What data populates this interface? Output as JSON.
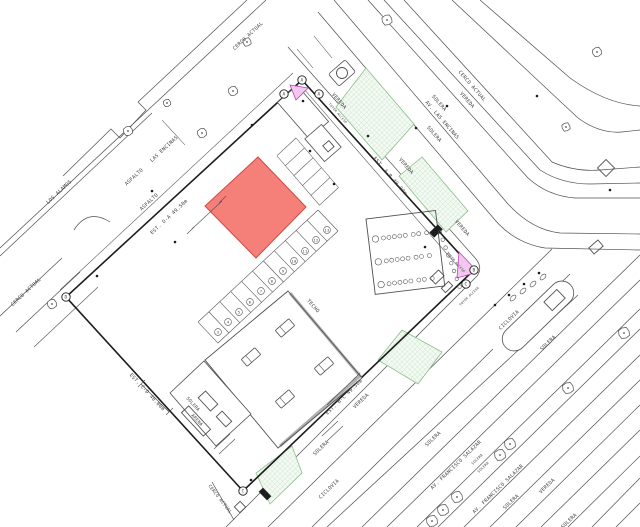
{
  "colors": {
    "line": "#4f4f4f",
    "boundary": "#1c1c1c",
    "text": "#3c3c3c",
    "dark": "#1d1d1d",
    "red_fill": "#f58079",
    "red_stroke": "#cf4a42",
    "green_bg": "#f4faf4",
    "green_line": "#b4d6b4",
    "green_stroke": "#8cbe8c",
    "pink_fill": "#f2c8f0",
    "pink_stroke": "#bf42bb"
  },
  "labels": {
    "street": [
      {
        "text": "CERCO ACTUAL",
        "x": 249,
        "y": 37,
        "rot": -43
      },
      {
        "text": "LAS ENCINAS",
        "x": 165,
        "y": 150,
        "rot": -43
      },
      {
        "text": "ASFALTO",
        "x": 135,
        "y": 178,
        "rot": -43
      },
      {
        "text": "ASFALTO",
        "x": 150,
        "y": 203,
        "rot": -43
      },
      {
        "text": "LOS ALAMOS",
        "x": 60,
        "y": 193,
        "rot": -43
      },
      {
        "text": "CERCO ACTUAL",
        "x": 27,
        "y": 293,
        "rot": -43
      },
      {
        "text": "CERCO ACTUAL",
        "x": 471,
        "y": 87,
        "rot": 49
      },
      {
        "text": "VEREDA",
        "x": 466,
        "y": 101,
        "rot": 49
      },
      {
        "text": "SOLERA",
        "x": 438,
        "y": 104,
        "rot": 49
      },
      {
        "text": "AV. LAS ENCINAS",
        "x": 441,
        "y": 121,
        "rot": 49
      },
      {
        "text": "SOLERA",
        "x": 433,
        "y": 135,
        "rot": 49
      },
      {
        "text": "VEREDA",
        "x": 338,
        "y": 102,
        "rot": 49
      },
      {
        "text": "VEREDA",
        "x": 405,
        "y": 167,
        "rot": 49
      },
      {
        "text": "VEREDA",
        "x": 461,
        "y": 229,
        "rot": 49
      },
      {
        "text": "TECHO",
        "x": 312,
        "y": 307,
        "rot": 49
      },
      {
        "text": "VEREDA",
        "x": 362,
        "y": 402,
        "rot": -44
      },
      {
        "text": "SOLERA",
        "x": 322,
        "y": 449,
        "rot": -44
      },
      {
        "text": "CICLOVIA",
        "x": 330,
        "y": 490,
        "rot": -44
      },
      {
        "text": "CICLOVIA",
        "x": 510,
        "y": 321,
        "rot": -44
      },
      {
        "text": "SOLERA",
        "x": 549,
        "y": 344,
        "rot": -44
      },
      {
        "text": "SOLERA",
        "x": 192,
        "y": 405,
        "rot": 47,
        "size": 4.5
      },
      {
        "text": "ARENA",
        "x": 196,
        "y": 421,
        "rot": 47,
        "size": 4.5
      },
      {
        "text": "CERCO ACTUAL",
        "x": 219,
        "y": 500,
        "rot": 52,
        "size": 4.5
      },
      {
        "text": "SOLERA",
        "x": 434,
        "y": 440,
        "rot": -44
      },
      {
        "text": "AV. FRANCISCO SALAZAR",
        "x": 457,
        "y": 466,
        "rot": -44
      },
      {
        "text": "SOLERA",
        "x": 478,
        "y": 460,
        "rot": -44,
        "size": 3.5
      },
      {
        "text": "SOLERA",
        "x": 484,
        "y": 468,
        "rot": -44,
        "size": 3.5
      },
      {
        "text": "AV. FRANCISCO SALAZAR",
        "x": 499,
        "y": 490,
        "rot": -44
      },
      {
        "text": "SOLERA",
        "x": 512,
        "y": 503,
        "rot": -44
      },
      {
        "text": "VEREDA",
        "x": 548,
        "y": 487,
        "rot": -44
      },
      {
        "text": "SOLERA",
        "x": 570,
        "y": 522,
        "rot": -44
      }
    ],
    "dimensions": [
      {
        "text": "EST. D-A 49.50m",
        "x": 170,
        "y": 218,
        "rot": -43
      },
      {
        "text": "EST. A-B 40.00m",
        "x": 389,
        "y": 177,
        "rot": 49
      },
      {
        "text": "EST. B-C 49.50m",
        "x": 345,
        "y": 398,
        "rot": -44
      },
      {
        "text": "EST. C-D 40.00m",
        "x": 146,
        "y": 393,
        "rot": 47
      }
    ],
    "small": [
      {
        "text": "TOTEM ACCESO",
        "x": 337,
        "y": 114,
        "rot": 49
      },
      {
        "text": "TOTEM ACCESO",
        "x": 455,
        "y": 263,
        "rot": 49
      },
      {
        "text": "TOTEM ACCESO",
        "x": 470,
        "y": 297,
        "rot": -44
      }
    ]
  },
  "markers": {
    "vertices": [
      {
        "letter": "A",
        "x": 302,
        "y": 80
      },
      {
        "letter": "B",
        "x": 474,
        "y": 270
      },
      {
        "letter": "C",
        "x": 243,
        "y": 491
      },
      {
        "letter": "D",
        "x": 66,
        "y": 297
      },
      {
        "letter": "A",
        "x": 284,
        "y": 94
      },
      {
        "letter": "A",
        "x": 319,
        "y": 94
      },
      {
        "letter": "C",
        "x": 466,
        "y": 284
      }
    ],
    "parking_numbers": [
      {
        "n": "13",
        "x": 327,
        "y": 230
      },
      {
        "n": "12",
        "x": 316,
        "y": 240
      },
      {
        "n": "11",
        "x": 305,
        "y": 251
      },
      {
        "n": "10",
        "x": 294,
        "y": 261
      },
      {
        "n": "9",
        "x": 283,
        "y": 271
      },
      {
        "n": "8",
        "x": 272,
        "y": 281
      },
      {
        "n": "7",
        "x": 261,
        "y": 291
      },
      {
        "n": "6",
        "x": 250,
        "y": 302
      },
      {
        "n": "5",
        "x": 239,
        "y": 312
      },
      {
        "n": "4",
        "x": 228,
        "y": 322
      },
      {
        "n": "3",
        "x": 218,
        "y": 332
      }
    ]
  },
  "symbols": {
    "trees": [
      {
        "x": 247,
        "y": 42,
        "r": 4.5
      },
      {
        "x": 233,
        "y": 91,
        "r": 5
      },
      {
        "x": 202,
        "y": 133,
        "r": 5
      },
      {
        "x": 128,
        "y": 131,
        "r": 5
      },
      {
        "x": 52,
        "y": 304,
        "r": 5
      },
      {
        "x": 167,
        "y": 103,
        "r": 4
      },
      {
        "x": 387,
        "y": 20,
        "r": 5.5
      },
      {
        "x": 566,
        "y": 127,
        "r": 4.5
      },
      {
        "x": 597,
        "y": 52,
        "r": 5
      },
      {
        "x": 624,
        "y": 333,
        "r": 6
      },
      {
        "x": 568,
        "y": 388,
        "r": 6
      },
      {
        "x": 510,
        "y": 444,
        "r": 6
      },
      {
        "x": 500,
        "y": 455,
        "r": 6
      },
      {
        "x": 457,
        "y": 497,
        "r": 6
      },
      {
        "x": 443,
        "y": 510,
        "r": 6
      },
      {
        "x": 432,
        "y": 521,
        "r": 6
      }
    ],
    "dots": [
      {
        "x": 152,
        "y": 191
      },
      {
        "x": 252,
        "y": 125
      },
      {
        "x": 310,
        "y": 151
      },
      {
        "x": 368,
        "y": 136
      },
      {
        "x": 416,
        "y": 128
      },
      {
        "x": 447,
        "y": 106
      },
      {
        "x": 537,
        "y": 96
      },
      {
        "x": 610,
        "y": 190
      },
      {
        "x": 97,
        "y": 276
      },
      {
        "x": 175,
        "y": 242
      },
      {
        "x": 334,
        "y": 184
      },
      {
        "x": 495,
        "y": 305
      },
      {
        "x": 509,
        "y": 295
      },
      {
        "x": 524,
        "y": 284
      },
      {
        "x": 539,
        "y": 273
      },
      {
        "x": 425,
        "y": 247
      },
      {
        "x": 303,
        "y": 101
      },
      {
        "x": 251,
        "y": 480
      }
    ],
    "bushes": [
      {
        "x": 513,
        "y": 298
      },
      {
        "x": 523,
        "y": 291
      },
      {
        "x": 533,
        "y": 284
      },
      {
        "x": 543,
        "y": 277
      }
    ]
  }
}
